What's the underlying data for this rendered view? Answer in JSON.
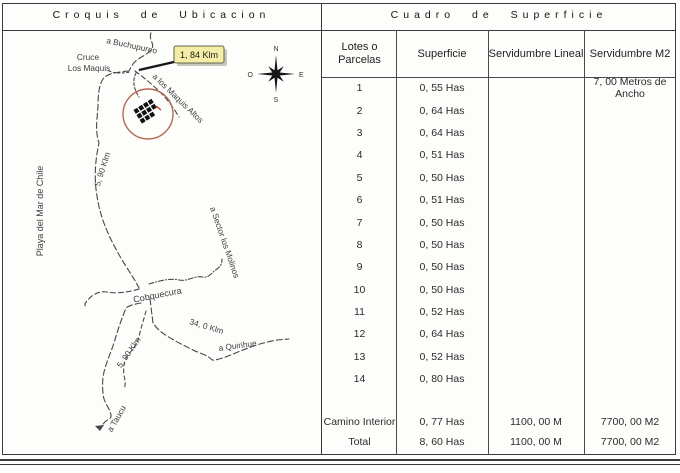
{
  "titles": {
    "left": "Croquis de Ubicacion",
    "right": "Cuadro de Superficie"
  },
  "map": {
    "labels": {
      "buchupureo": "a Buchupureo",
      "cruce_line1": "Cruce",
      "cruce_line2": "Los Maquis",
      "distance_tag": "1, 84 Klm",
      "maquis_altos": "a los Maquis Altos",
      "km_upper": "5, 90 Klm",
      "playa": "Playa del Mar de Chile",
      "sector_molinos": "a Sector los Molinos",
      "cobquecura": "Cobquecura",
      "km_34": "34, 0 Klm",
      "quirihue": "a Quirihue",
      "km_lower": "5, 90 Klm",
      "taucu": "a Taucu"
    },
    "compass": {
      "n": "N",
      "s": "S",
      "e": "E",
      "o": "O"
    },
    "colors": {
      "site_circle": "#b26a55",
      "distance_tag_bg": "#f3eda6",
      "building": "#111111",
      "red_mark": "#c0392b"
    }
  },
  "table": {
    "headers": [
      "Lotes o Parcelas",
      "Superficie",
      "Servidumbre Lineal",
      "Servidumbre M2"
    ],
    "rows": [
      {
        "lote": "1",
        "superficie": "0, 55 Has",
        "lineal": "",
        "m2": "7, 00 Metros de Ancho"
      },
      {
        "lote": "2",
        "superficie": "0, 64 Has",
        "lineal": "",
        "m2": ""
      },
      {
        "lote": "3",
        "superficie": "0, 64 Has",
        "lineal": "",
        "m2": ""
      },
      {
        "lote": "4",
        "superficie": "0, 51 Has",
        "lineal": "",
        "m2": ""
      },
      {
        "lote": "5",
        "superficie": "0, 50 Has",
        "lineal": "",
        "m2": ""
      },
      {
        "lote": "6",
        "superficie": "0, 51 Has",
        "lineal": "",
        "m2": ""
      },
      {
        "lote": "7",
        "superficie": "0, 50 Has",
        "lineal": "",
        "m2": ""
      },
      {
        "lote": "8",
        "superficie": "0, 50 Has",
        "lineal": "",
        "m2": ""
      },
      {
        "lote": "9",
        "superficie": "0, 50 Has",
        "lineal": "",
        "m2": ""
      },
      {
        "lote": "10",
        "superficie": "0, 50 Has",
        "lineal": "",
        "m2": ""
      },
      {
        "lote": "11",
        "superficie": "0, 52 Has",
        "lineal": "",
        "m2": ""
      },
      {
        "lote": "12",
        "superficie": "0, 64 Has",
        "lineal": "",
        "m2": ""
      },
      {
        "lote": "13",
        "superficie": "0, 52 Has",
        "lineal": "",
        "m2": ""
      },
      {
        "lote": "14",
        "superficie": "0, 80 Has",
        "lineal": "",
        "m2": ""
      },
      {
        "lote": "Camino Interior",
        "superficie": "0, 77 Has",
        "lineal": "1100, 00 M",
        "m2": "7700, 00 M2"
      },
      {
        "lote": "Total",
        "superficie": "8, 60 Has",
        "lineal": "1100, 00 M",
        "m2": "7700, 00 M2"
      }
    ]
  }
}
